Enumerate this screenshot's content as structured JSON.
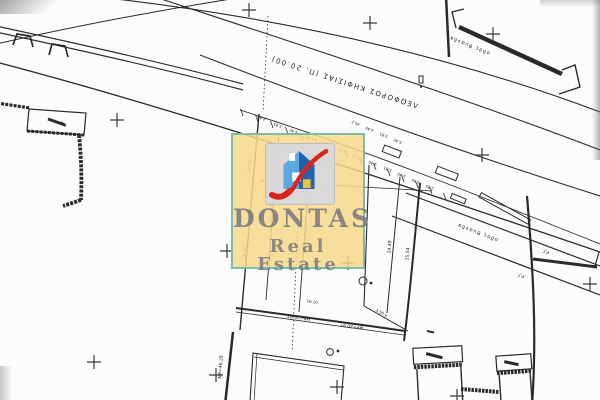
{
  "watermark": {
    "brand": "DONTAS",
    "tagline": "Real Estate",
    "colors": {
      "panel": "#f6d98b",
      "border": "#7cbcab",
      "text": "#84858e",
      "tile": "#d9d9dd",
      "house_light": "#5ea9dd",
      "house_dark": "#2363ae",
      "swoosh": "#d8251f",
      "door": "#eec23e",
      "window": "#ffffff"
    }
  },
  "map": {
    "avenue_label": "ΛΕΩΦΟΡΟΣ ΚΗΦΙΣΙΑΣ (Π. 20.00)",
    "side_street_label": "οδός Βυανδα",
    "side_street_label_2": "οδός Βυανδα",
    "boundary_labels": [
      {
        "t": "18.90"
      },
      {
        "t": "18.40"
      },
      {
        "t": "24.49"
      },
      {
        "t": "25.54"
      },
      {
        "t": "ΜΡ=20.97"
      },
      {
        "t": "ΜΡ=20.97"
      },
      {
        "t": "16.10"
      },
      {
        "t": "ΜΡ=46.29"
      },
      {
        "t": "3.50 μ"
      },
      {
        "t": "Ρ.Γ."
      },
      {
        "t": "Ρ.Γ."
      },
      {
        "t": "19.11"
      },
      {
        "t": "τσιμ. μάντρα"
      },
      {
        "t": "πέτρινη μάντρα"
      }
    ],
    "road_dims": [
      "4.40",
      "5.81",
      "5.40",
      "4.00",
      "2.85",
      "3.64",
      "10.52",
      "4.40",
      "5.81",
      "5.40",
      "4.00",
      "2.85",
      "45.2",
      "4.40",
      "5.81",
      "5.40"
    ]
  }
}
